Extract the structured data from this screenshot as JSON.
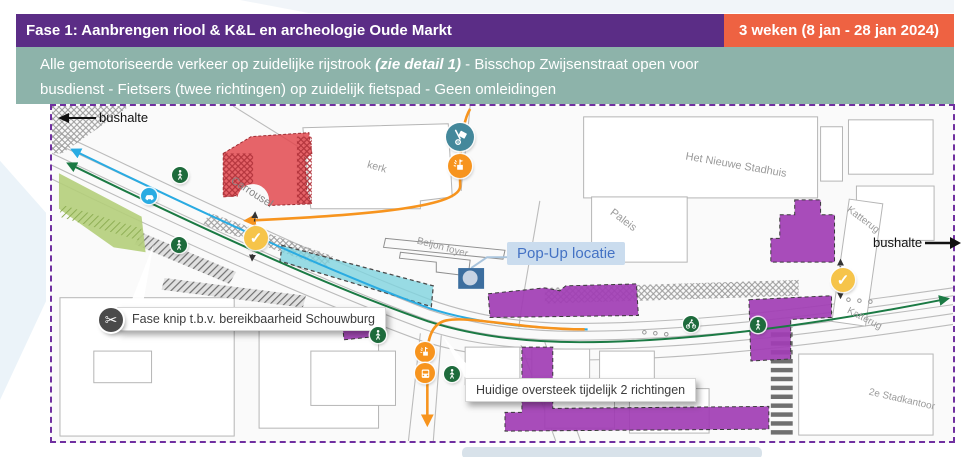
{
  "header": {
    "title": "Fase 1: Aanbrengen riool & K&L en archeologie Oude Markt",
    "duration": "3 weken  (8 jan - 28 jan 2024)"
  },
  "infobar": {
    "line1_pre": "Alle gemotoriseerde verkeer op zuidelijke rijstrook ",
    "line1_em": "(zie detail 1)",
    "line1_post": " -  Bisschop Zwijsenstraat open voor",
    "line2": "busdienst - Fietsers (twee richtingen) op zuidelijk fietspad - Geen omleidingen"
  },
  "map": {
    "annotations": {
      "bushalte_left": "bushalte",
      "bushalte_right": "bushalte",
      "popup_label": "Pop-Up locatie",
      "fase_knip": "Fase knip t.b.v. bereikbaarheid Schouwburg",
      "oversteek": "Huidige oversteek tijdelijk 2 richtingen"
    },
    "places": {
      "kerk": "kerk",
      "carrousel": "Carrousel",
      "stadhuis": "Het Nieuwe Stadhuis",
      "paleis": "Paleis",
      "katterug_top": "Katterug",
      "katterug_bottom": "Katterug",
      "stadkantoor": "2e Stadkantoor",
      "beljon": "Beljon foyer",
      "hof": "hof"
    },
    "glyphs": {
      "check": "✓",
      "scissors": "✂"
    }
  },
  "colors": {
    "header-purple": "#5B2D86",
    "header-orange": "#EE6242",
    "infobar-teal": "#8DB3AA",
    "border-purple": "#7030A0",
    "overlay-red": "#E2494F",
    "overlay-green": "#B4CE7A",
    "overlay-teal": "#7FD3DF",
    "overlay-purple": "#A13DB4",
    "line-blue": "#29ABE2",
    "line-green": "#1B7A44",
    "route-orange": "#F7941E",
    "icon-green": "#1E6B3C",
    "icon-blue": "#29ABE2",
    "icon-teal": "#44889B",
    "check-yellow": "#F6C44A",
    "popup-blue": "#4472C4",
    "popup-bg": "#CADCEE",
    "scissors-dark": "#4A4A4A"
  }
}
